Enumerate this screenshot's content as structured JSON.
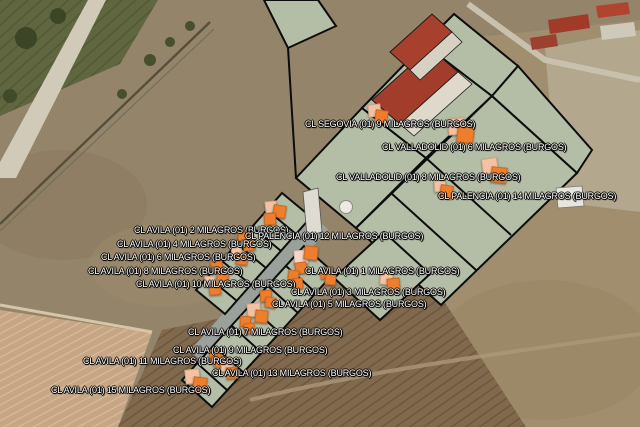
{
  "map": {
    "type": "satellite-aerial",
    "municipality": "MILAGROS (BURGOS)",
    "colors": {
      "marker_orange": "#ee7e2b",
      "marker_light": "#f4c2a0",
      "marker_pale": "#f5d6c9",
      "label_text": "#ffffff",
      "label_outline": "#000000",
      "parcel_fill": "#b4bea6",
      "parcel_stroke": "#0c0c0c"
    },
    "labels": [
      {
        "id": "segovia-9",
        "text": "CL SEGOVIA (01) 9 MILAGROS (BURGOS)",
        "x": 305,
        "y": 119
      },
      {
        "id": "valladolid-6",
        "text": "CL VALLADOLID (01) 6 MILAGROS (BURGOS)",
        "x": 382,
        "y": 142
      },
      {
        "id": "valladolid-8",
        "text": "CL VALLADOLID (01) 8 MILAGROS (BURGOS)",
        "x": 336,
        "y": 172
      },
      {
        "id": "palencia-14",
        "text": "CL PALENCIA (01) 14 MILAGROS (BURGOS)",
        "x": 438,
        "y": 191
      },
      {
        "id": "avila-2",
        "text": "CL AVILA (01) 2 MILAGROS (BURGOS)",
        "x": 134,
        "y": 225
      },
      {
        "id": "avila-4",
        "text": "CL AVILA (01) 4 MILAGROS (BURGOS)",
        "x": 117,
        "y": 239
      },
      {
        "id": "avila-6",
        "text": "CL AVILA (01) 6 MILAGROS (BURGOS)",
        "x": 101,
        "y": 252
      },
      {
        "id": "avila-8",
        "text": "CL AVILA (01) 8 MILAGROS (BURGOS)",
        "x": 88,
        "y": 266
      },
      {
        "id": "avila-10",
        "text": "CL AVILA (01) 10 MILAGROS (BURGOS)",
        "x": 136,
        "y": 279
      },
      {
        "id": "palencia-12",
        "text": "CL PALENCIA (01) 12 MILAGROS (BURGOS)",
        "x": 245,
        "y": 231
      },
      {
        "id": "avila-1",
        "text": "CL AVILA (01) 1 MILAGROS (BURGOS)",
        "x": 305,
        "y": 266
      },
      {
        "id": "avila-3",
        "text": "CL AVILA (01) 3 MILAGROS (BURGOS)",
        "x": 291,
        "y": 287
      },
      {
        "id": "avila-5",
        "text": "CL AVILA (01) 5 MILAGROS (BURGOS)",
        "x": 272,
        "y": 299
      },
      {
        "id": "avila-7",
        "text": "CL AVILA (01) 7 MILAGROS (BURGOS)",
        "x": 188,
        "y": 327
      },
      {
        "id": "avila-9",
        "text": "CL AVILA (01) 9 MILAGROS (BURGOS)",
        "x": 173,
        "y": 345
      },
      {
        "id": "avila-11",
        "text": "CL AVILA (01) 11 MILAGROS (BURGOS)",
        "x": 83,
        "y": 356
      },
      {
        "id": "avila-13",
        "text": "CL AVILA (01) 13 MILAGROS (BURGOS)",
        "x": 212,
        "y": 368
      },
      {
        "id": "avila-15",
        "text": "CL AVILA (01) 15 MILAGROS (BURGOS)",
        "x": 51,
        "y": 385
      }
    ],
    "markers": [
      {
        "id": "m-segovia",
        "x": 368,
        "y": 104,
        "squares": [
          {
            "dx": 0,
            "dy": 0,
            "s": 11,
            "c": "marker_light",
            "rot": -6
          },
          {
            "dx": 7,
            "dy": 6,
            "s": 11,
            "c": "marker_orange",
            "rot": 8
          }
        ]
      },
      {
        "id": "m-valladolid6",
        "x": 448,
        "y": 118,
        "squares": [
          {
            "dx": 0,
            "dy": 0,
            "s": 15,
            "c": "marker_light",
            "rot": -5
          },
          {
            "dx": 9,
            "dy": 8,
            "s": 15,
            "c": "marker_orange",
            "rot": 7
          }
        ]
      },
      {
        "id": "m-valladolid8",
        "x": 482,
        "y": 158,
        "squares": [
          {
            "dx": 0,
            "dy": 0,
            "s": 14,
            "c": "marker_light",
            "rot": -8
          },
          {
            "dx": 9,
            "dy": 9,
            "s": 14,
            "c": "marker_orange",
            "rot": 6
          }
        ]
      },
      {
        "id": "m-palencia14",
        "x": 434,
        "y": 180,
        "squares": [
          {
            "dx": 0,
            "dy": 0,
            "s": 10,
            "c": "marker_light",
            "rot": -4
          },
          {
            "dx": 6,
            "dy": 5,
            "s": 11,
            "c": "marker_orange",
            "rot": 10
          }
        ]
      },
      {
        "id": "m-avila2",
        "x": 265,
        "y": 201,
        "squares": [
          {
            "dx": 0,
            "dy": 0,
            "s": 10,
            "c": "marker_light",
            "rot": -6
          },
          {
            "dx": 8,
            "dy": 4,
            "s": 11,
            "c": "marker_orange",
            "rot": 9
          },
          {
            "dx": -1,
            "dy": 12,
            "s": 10,
            "c": "marker_orange",
            "rot": -4
          }
        ]
      },
      {
        "id": "m-avila4",
        "x": 238,
        "y": 230,
        "squares": [
          {
            "dx": 0,
            "dy": 0,
            "s": 10,
            "c": "marker_orange",
            "rot": 6
          },
          {
            "dx": 5,
            "dy": 9,
            "s": 10,
            "c": "marker_orange",
            "rot": -7
          }
        ]
      },
      {
        "id": "m-avila6",
        "x": 231,
        "y": 246,
        "squares": [
          {
            "dx": 0,
            "dy": 0,
            "s": 9,
            "c": "marker_light",
            "rot": -5
          },
          {
            "dx": 5,
            "dy": 7,
            "s": 10,
            "c": "marker_orange",
            "rot": 8
          }
        ]
      },
      {
        "id": "m-avila8",
        "x": 211,
        "y": 261,
        "squares": [
          {
            "dx": 0,
            "dy": 0,
            "s": 10,
            "c": "marker_orange",
            "rot": -8
          },
          {
            "dx": 6,
            "dy": 8,
            "s": 10,
            "c": "marker_orange",
            "rot": 6
          }
        ]
      },
      {
        "id": "m-avila10",
        "x": 204,
        "y": 276,
        "squares": [
          {
            "dx": 0,
            "dy": 0,
            "s": 9,
            "c": "marker_light",
            "rot": 5
          },
          {
            "dx": 5,
            "dy": 7,
            "s": 10,
            "c": "marker_orange",
            "rot": -6
          }
        ]
      },
      {
        "id": "m-avila1",
        "x": 294,
        "y": 250,
        "squares": [
          {
            "dx": 0,
            "dy": 0,
            "s": 12,
            "c": "marker_pale",
            "rot": -4
          },
          {
            "dx": 10,
            "dy": -4,
            "s": 12,
            "c": "marker_orange",
            "rot": 7
          },
          {
            "dx": 1,
            "dy": 12,
            "s": 10,
            "c": "marker_orange",
            "rot": -8
          }
        ]
      },
      {
        "id": "m-avila3a",
        "x": 288,
        "y": 270,
        "squares": [
          {
            "dx": 0,
            "dy": 0,
            "s": 9,
            "c": "marker_orange",
            "rot": 8
          },
          {
            "dx": 4,
            "dy": 8,
            "s": 9,
            "c": "marker_orange",
            "rot": -5
          }
        ]
      },
      {
        "id": "m-avila3b",
        "x": 320,
        "y": 267,
        "squares": [
          {
            "dx": 0,
            "dy": 0,
            "s": 10,
            "c": "marker_orange",
            "rot": -7
          },
          {
            "dx": 5,
            "dy": 7,
            "s": 9,
            "c": "marker_orange",
            "rot": 5
          }
        ]
      },
      {
        "id": "m-palencia12",
        "x": 380,
        "y": 272,
        "squares": [
          {
            "dx": 0,
            "dy": 0,
            "s": 11,
            "c": "marker_light",
            "rot": 6
          },
          {
            "dx": 7,
            "dy": 6,
            "s": 11,
            "c": "marker_orange",
            "rot": -6
          }
        ]
      },
      {
        "id": "m-avila5",
        "x": 260,
        "y": 290,
        "squares": [
          {
            "dx": 0,
            "dy": 0,
            "s": 10,
            "c": "marker_orange",
            "rot": -5
          },
          {
            "dx": 5,
            "dy": 7,
            "s": 9,
            "c": "marker_orange",
            "rot": 8
          }
        ]
      },
      {
        "id": "m-avila7",
        "x": 247,
        "y": 303,
        "squares": [
          {
            "dx": 0,
            "dy": 0,
            "s": 12,
            "c": "marker_light",
            "rot": -6
          },
          {
            "dx": 8,
            "dy": 7,
            "s": 11,
            "c": "marker_orange",
            "rot": 6
          }
        ]
      },
      {
        "id": "m-avila9",
        "x": 240,
        "y": 316,
        "squares": [
          {
            "dx": 0,
            "dy": 0,
            "s": 9,
            "c": "marker_orange",
            "rot": 4
          },
          {
            "dx": 4,
            "dy": 7,
            "s": 9,
            "c": "marker_orange",
            "rot": -7
          }
        ]
      },
      {
        "id": "m-avila11",
        "x": 209,
        "y": 349,
        "squares": [
          {
            "dx": 0,
            "dy": 0,
            "s": 10,
            "c": "marker_orange",
            "rot": -6
          },
          {
            "dx": 5,
            "dy": 7,
            "s": 10,
            "c": "marker_orange",
            "rot": 7
          }
        ]
      },
      {
        "id": "m-avila13",
        "x": 221,
        "y": 360,
        "squares": [
          {
            "dx": 0,
            "dy": 0,
            "s": 10,
            "c": "marker_light",
            "rot": 5
          },
          {
            "dx": 5,
            "dy": 7,
            "s": 10,
            "c": "marker_orange",
            "rot": -5
          }
        ]
      },
      {
        "id": "m-avila15",
        "x": 185,
        "y": 369,
        "squares": [
          {
            "dx": 0,
            "dy": 0,
            "s": 13,
            "c": "marker_light",
            "rot": -6
          },
          {
            "dx": 8,
            "dy": 8,
            "s": 12,
            "c": "marker_orange",
            "rot": 7
          }
        ]
      }
    ]
  }
}
